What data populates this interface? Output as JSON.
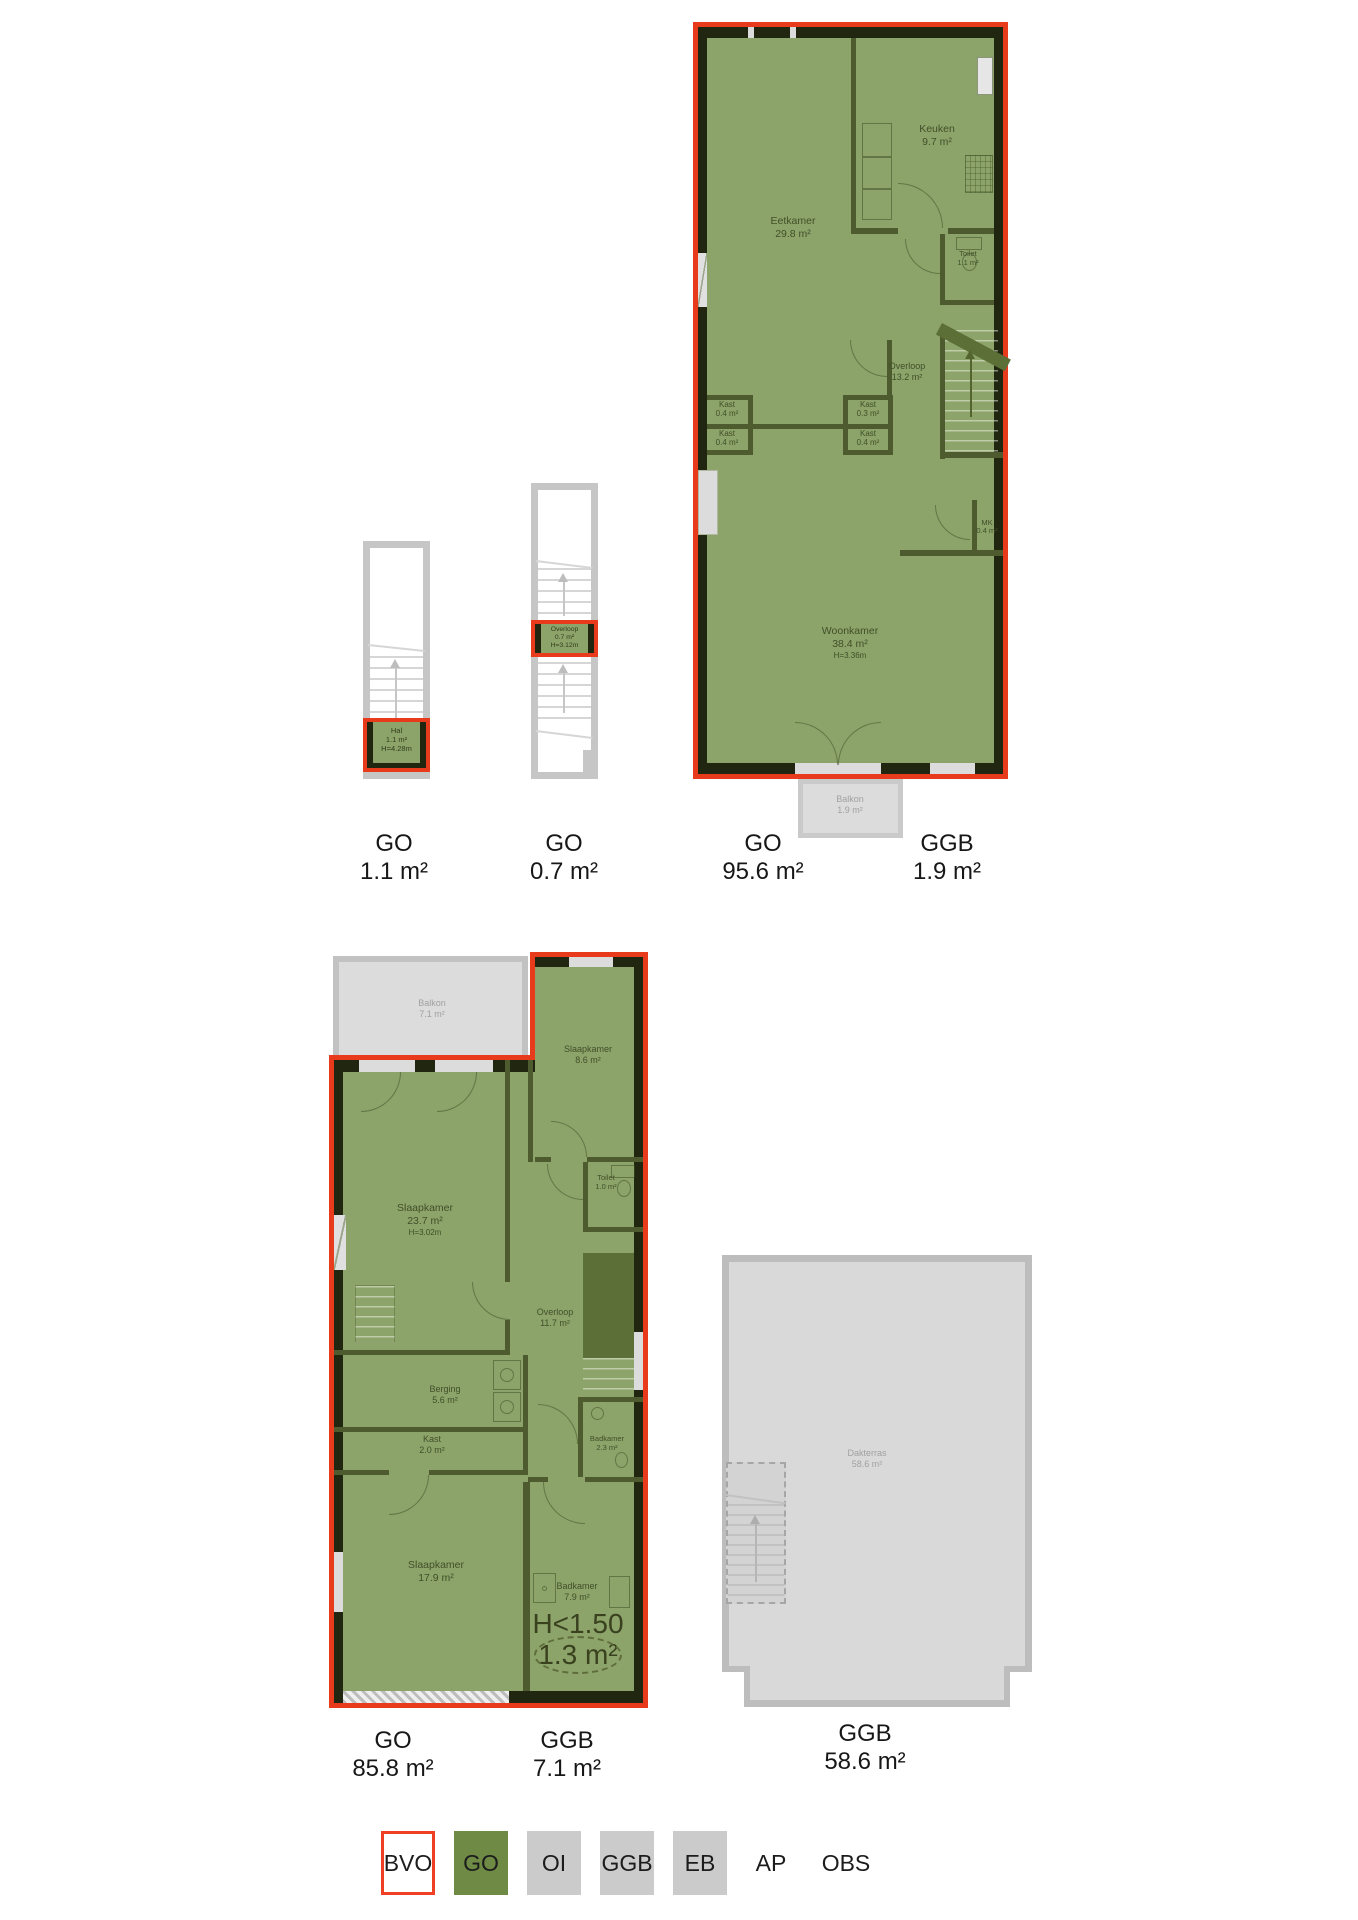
{
  "plans": {
    "stair_hal": {
      "room": {
        "name": "Hal",
        "area": "1.1 m²",
        "height": "H=4.28m"
      },
      "caption": {
        "code": "GO",
        "area": "1.1 m²"
      }
    },
    "stair_overloop": {
      "room": {
        "name": "Overloop",
        "area": "0.7 m²",
        "height": "H=3.12m"
      },
      "caption": {
        "code": "GO",
        "area": "0.7 m²"
      }
    },
    "floor_living": {
      "rooms": {
        "keuken": {
          "name": "Keuken",
          "area": "9.7 m²"
        },
        "eetkamer": {
          "name": "Eetkamer",
          "area": "29.8 m²"
        },
        "toilet": {
          "name": "Toilet",
          "area": "1.1 m²"
        },
        "overloop": {
          "name": "Overloop",
          "area": "13.2 m²"
        },
        "kast_left_top": {
          "name": "Kast",
          "area": "0.4 m²"
        },
        "kast_left_bottom": {
          "name": "Kast",
          "area": "0.4 m²"
        },
        "kast_mid_top": {
          "name": "Kast",
          "area": "0.3 m²"
        },
        "kast_mid_bottom": {
          "name": "Kast",
          "area": "0.4 m²"
        },
        "mk": {
          "name": "MK",
          "area": "0.4 m²"
        },
        "woonkamer": {
          "name": "Woonkamer",
          "area": "38.4 m²",
          "height": "H=3.36m"
        },
        "balkon": {
          "name": "Balkon",
          "area": "1.9 m²"
        }
      },
      "captions": {
        "go": {
          "code": "GO",
          "area": "95.6 m²"
        },
        "ggb": {
          "code": "GGB",
          "area": "1.9 m²"
        }
      }
    },
    "floor_sleeping": {
      "rooms": {
        "balkon": {
          "name": "Balkon",
          "area": "7.1 m²"
        },
        "slaapkamer_small": {
          "name": "Slaapkamer",
          "area": "8.6 m²"
        },
        "toilet": {
          "name": "Toilet",
          "area": "1.0 m²"
        },
        "slaapkamer_large": {
          "name": "Slaapkamer",
          "area": "23.7 m²",
          "height": "H=3.02m"
        },
        "overloop": {
          "name": "Overloop",
          "area": "11.7 m²"
        },
        "berging": {
          "name": "Berging",
          "area": "5.6 m²"
        },
        "kast": {
          "name": "Kast",
          "area": "2.0 m²"
        },
        "badkamer_small": {
          "name": "Badkamer",
          "area": "2.3 m²"
        },
        "slaapkamer_bottom": {
          "name": "Slaapkamer",
          "area": "17.9 m²"
        },
        "badkamer_large": {
          "name": "Badkamer",
          "area": "7.9 m²"
        },
        "low_height": {
          "label": "H<1.50",
          "area": "1.3 m²"
        }
      },
      "captions": {
        "go": {
          "code": "GO",
          "area": "85.8 m²"
        },
        "ggb": {
          "code": "GGB",
          "area": "7.1 m²"
        }
      }
    },
    "roof": {
      "rooms": {
        "dakterras": {
          "name": "Dakterras",
          "area": "58.6 m²"
        }
      },
      "caption": {
        "code": "GGB",
        "area": "58.6 m²"
      }
    }
  },
  "legend": {
    "items": [
      {
        "label": "BVO",
        "style": "bvo"
      },
      {
        "label": "GO",
        "style": "go"
      },
      {
        "label": "OI",
        "style": "gray"
      },
      {
        "label": "GGB",
        "style": "gray"
      },
      {
        "label": "EB",
        "style": "gray"
      },
      {
        "label": "AP",
        "style": "plain"
      },
      {
        "label": "OBS",
        "style": "plain"
      }
    ]
  },
  "colors": {
    "outline_red": "#e83b1c",
    "go_green": "#8ca369",
    "legend_green": "#6e8a44",
    "ggb_gray": "#d9d9d9"
  }
}
